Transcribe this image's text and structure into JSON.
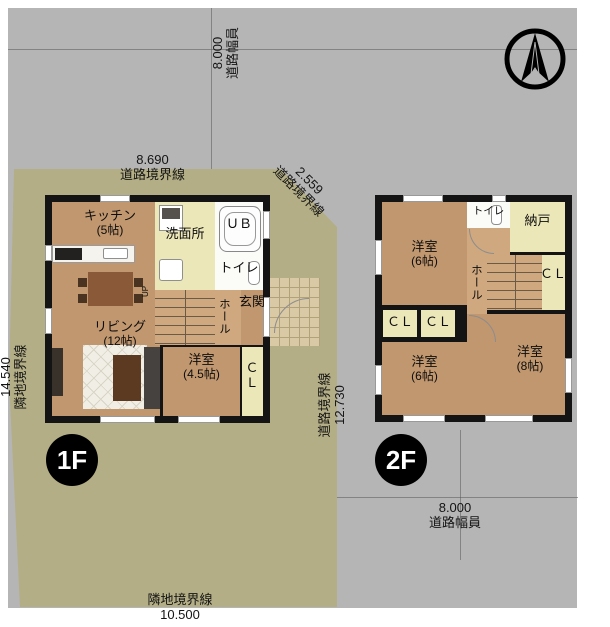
{
  "colors": {
    "road": "#b5b5b5",
    "lot": "#b3ae85",
    "wood": "#c1976f",
    "wood_light": "#cfa87f",
    "pale": "#ece7b8",
    "wall": "#141414",
    "white_room": "#fbfbf8"
  },
  "site": {
    "top_road": {
      "value": "8.000",
      "label": "道路幅員"
    },
    "top_boundary": {
      "value": "8.690",
      "label": "道路境界線"
    },
    "diagonal_boundary": {
      "value": "2.559",
      "label": "道路境界線"
    },
    "left_boundary": {
      "value": "14.540",
      "label": "隣地境界線"
    },
    "right_boundary": {
      "label": "道路境界線",
      "value": "12.730"
    },
    "bottom_road": {
      "value": "8.000",
      "label": "道路幅員"
    },
    "bottom_boundary": {
      "label": "隣地境界線",
      "value": "10.500"
    }
  },
  "floor1": {
    "badge": "1F",
    "kitchen": {
      "name": "キッチン",
      "size": "(5帖)"
    },
    "washroom": {
      "name": "洗面所"
    },
    "bath": {
      "name": "ＵＢ"
    },
    "toilet": {
      "name": "トイレ"
    },
    "hall": {
      "name": "ホール"
    },
    "entrance": {
      "name": "玄関"
    },
    "living": {
      "name": "リビング",
      "size": "(12帖)"
    },
    "bedroom": {
      "name": "洋室",
      "size": "(4.5帖)"
    },
    "closet": {
      "name": "ＣＬ"
    },
    "stairs": {
      "name": "UP"
    }
  },
  "floor2": {
    "badge": "2F",
    "bedroom_nw": {
      "name": "洋室",
      "size": "(6帖)"
    },
    "toilet": {
      "name": "トイレ"
    },
    "storeroom": {
      "name": "納戸"
    },
    "hall": {
      "name": "ホール"
    },
    "closet_right": {
      "name": "ＣＬ"
    },
    "closet_a": {
      "name": "ＣＬ"
    },
    "closet_b": {
      "name": "ＣＬ"
    },
    "bedroom_sw": {
      "name": "洋室",
      "size": "(6帖)"
    },
    "bedroom_se": {
      "name": "洋室",
      "size": "(8帖)"
    }
  }
}
